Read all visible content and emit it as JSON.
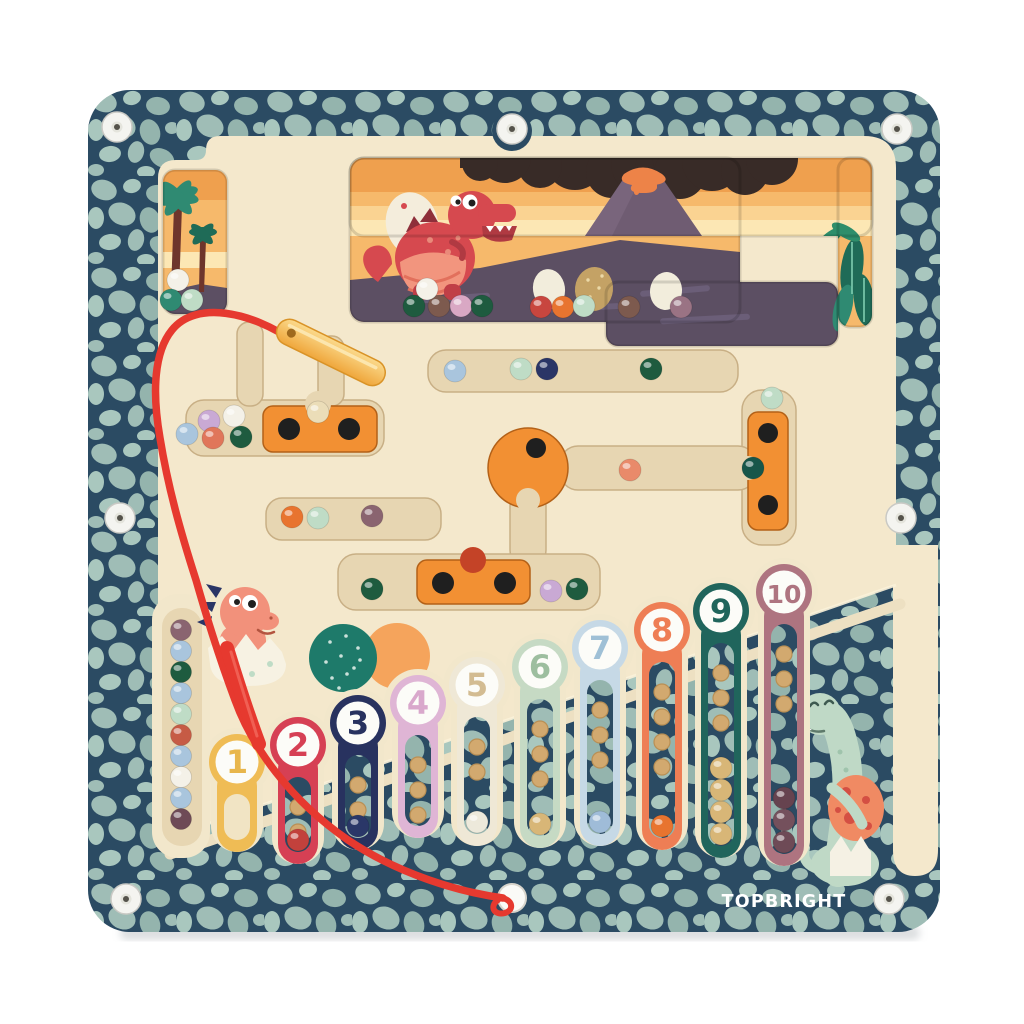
{
  "brand": {
    "logo_text": "TOPBRIGHT",
    "logo_color": "#FFFFFF"
  },
  "board": {
    "screw_count": 7
  },
  "tubes": [
    {
      "label": "1",
      "color": "#EFBC55",
      "text_color": "#E8B64B",
      "interior": "cream",
      "holes": 0,
      "balls": []
    },
    {
      "label": "2",
      "color": "#D64054",
      "text_color": "#D64054",
      "interior": "pebble",
      "holes": 2,
      "balls": [
        "#C2413C"
      ]
    },
    {
      "label": "3",
      "color": "#28325F",
      "text_color": "#28325F",
      "interior": "pebble",
      "holes": 2,
      "balls": [
        "#2A3768"
      ]
    },
    {
      "label": "4",
      "color": "#DFB5D5",
      "text_color": "#D9A8CC",
      "interior": "pebble",
      "holes": 3,
      "balls": []
    },
    {
      "label": "5",
      "color": "#EFE8D6",
      "text_color": "#D3BC92",
      "interior": "pebble",
      "holes": 2,
      "balls": [
        "#EDE9DB"
      ]
    },
    {
      "label": "6",
      "color": "#C6DAC4",
      "text_color": "#9DBE9F",
      "interior": "pebble",
      "holes": 3,
      "balls": [
        "#D8B677"
      ]
    },
    {
      "label": "7",
      "color": "#C6D9E6",
      "text_color": "#9FC0D6",
      "interior": "pebble",
      "holes": 3,
      "balls": [
        "#9FBCD8"
      ]
    },
    {
      "label": "8",
      "color": "#EE7E55",
      "text_color": "#EE7E55",
      "interior": "pebble",
      "holes": 4,
      "balls": [
        "#E8742F"
      ]
    },
    {
      "label": "9",
      "color": "#20655C",
      "text_color": "#20655C",
      "interior": "pebble",
      "holes": 3,
      "balls": [
        "#D8B677",
        "#D8B677",
        "#D8B677",
        "#D8B677"
      ]
    },
    {
      "label": "10",
      "color": "#AE7480",
      "text_color": "#AE7480",
      "interior": "pebble",
      "holes": 3,
      "balls": [
        "#6E4A56",
        "#74505C",
        "#66434F"
      ]
    }
  ],
  "left_column_balls": [
    "#8A6470",
    "#A9C5DD",
    "#1E5B3F",
    "#A9C5DD",
    "#BFDCC6",
    "#C65B45",
    "#A9C5DD",
    "#F4F1E8",
    "#A9C5DD",
    "#6E4A56"
  ],
  "loose_balls": {
    "scene_floor": [
      [
        414,
        306,
        "#1E5B3F"
      ],
      [
        439,
        306,
        "#7D5A4E"
      ],
      [
        461,
        306,
        "#D9A8C4"
      ],
      [
        482,
        306,
        "#1E5B3F"
      ],
      [
        427,
        289,
        "#F4F1E8"
      ],
      [
        541,
        307,
        "#C8463F"
      ],
      [
        563,
        307,
        "#E8742F"
      ],
      [
        584,
        306,
        "#BFDCC6"
      ],
      [
        629,
        307,
        "#7D5A4E"
      ],
      [
        681,
        307,
        "#9A7384"
      ]
    ],
    "palm_window": [
      [
        178,
        280,
        "#F4F1E8"
      ],
      [
        171,
        300,
        "#2F8A72"
      ],
      [
        192,
        300,
        "#BFDCC6"
      ]
    ],
    "left_pocket": [
      [
        209,
        421,
        "#C9A9D4"
      ],
      [
        234,
        416,
        "#F4F1E8"
      ],
      [
        187,
        434,
        "#A9C5DD"
      ],
      [
        213,
        438,
        "#E0765A"
      ],
      [
        241,
        437,
        "#1E5B3F"
      ]
    ],
    "slider_notch": [
      [
        318,
        412,
        "#EBDDB8"
      ]
    ],
    "upper_channel": [
      [
        455,
        371,
        "#A9C5DD"
      ],
      [
        521,
        369,
        "#BFDCC6"
      ],
      [
        547,
        369,
        "#2A3566"
      ],
      [
        651,
        369,
        "#1E5B3F"
      ]
    ],
    "middle_channel": [
      [
        630,
        470,
        "#E98A6A"
      ]
    ],
    "t_piece_area": [
      [
        772,
        398,
        "#BFDCC6"
      ],
      [
        753,
        468,
        "#17564A"
      ]
    ],
    "mid_left_channel": [
      [
        292,
        517,
        "#E8742F"
      ],
      [
        318,
        518,
        "#BFDCC6"
      ],
      [
        372,
        516,
        "#8A6470"
      ]
    ],
    "lower_channel": [
      [
        372,
        589,
        "#1E5B3F"
      ],
      [
        551,
        591,
        "#C9A9D4"
      ],
      [
        577,
        589,
        "#1E5B3F"
      ]
    ]
  },
  "decor": {
    "dotted_circle_color": "#1E7A6A",
    "solid_circle_color": "#F5A45C"
  },
  "scene": {
    "characters": [
      "red-trex",
      "baby-dino-hatchling",
      "green-long-neck-dino"
    ],
    "plants": [
      "palm-trees",
      "jungle-leaves"
    ],
    "props": [
      "volcano",
      "lava",
      "smoke-cloud",
      "dino-eggs"
    ],
    "sky_colors": [
      "#EFA04E",
      "#F6B96B",
      "#FAD392",
      "#FCE7B4"
    ],
    "ground_color": "#5C4F63",
    "smoke_color": "#382B27",
    "volcano_color": "#6F5C72",
    "lava_color": "#ED8348"
  },
  "palette": {
    "frame_base": "#2B4B63",
    "frame_pebble": "#9FBDB6",
    "board": "#F4E8CC",
    "board_edge": "#EDE0C2",
    "channel": "#E7D6B2",
    "slider_orange": "#F29033",
    "slider_dot": "#1F1F1F",
    "wand_stick": "#F6BC4C",
    "wand_cord": "#E6392F",
    "screw": "#F4F4F0"
  }
}
